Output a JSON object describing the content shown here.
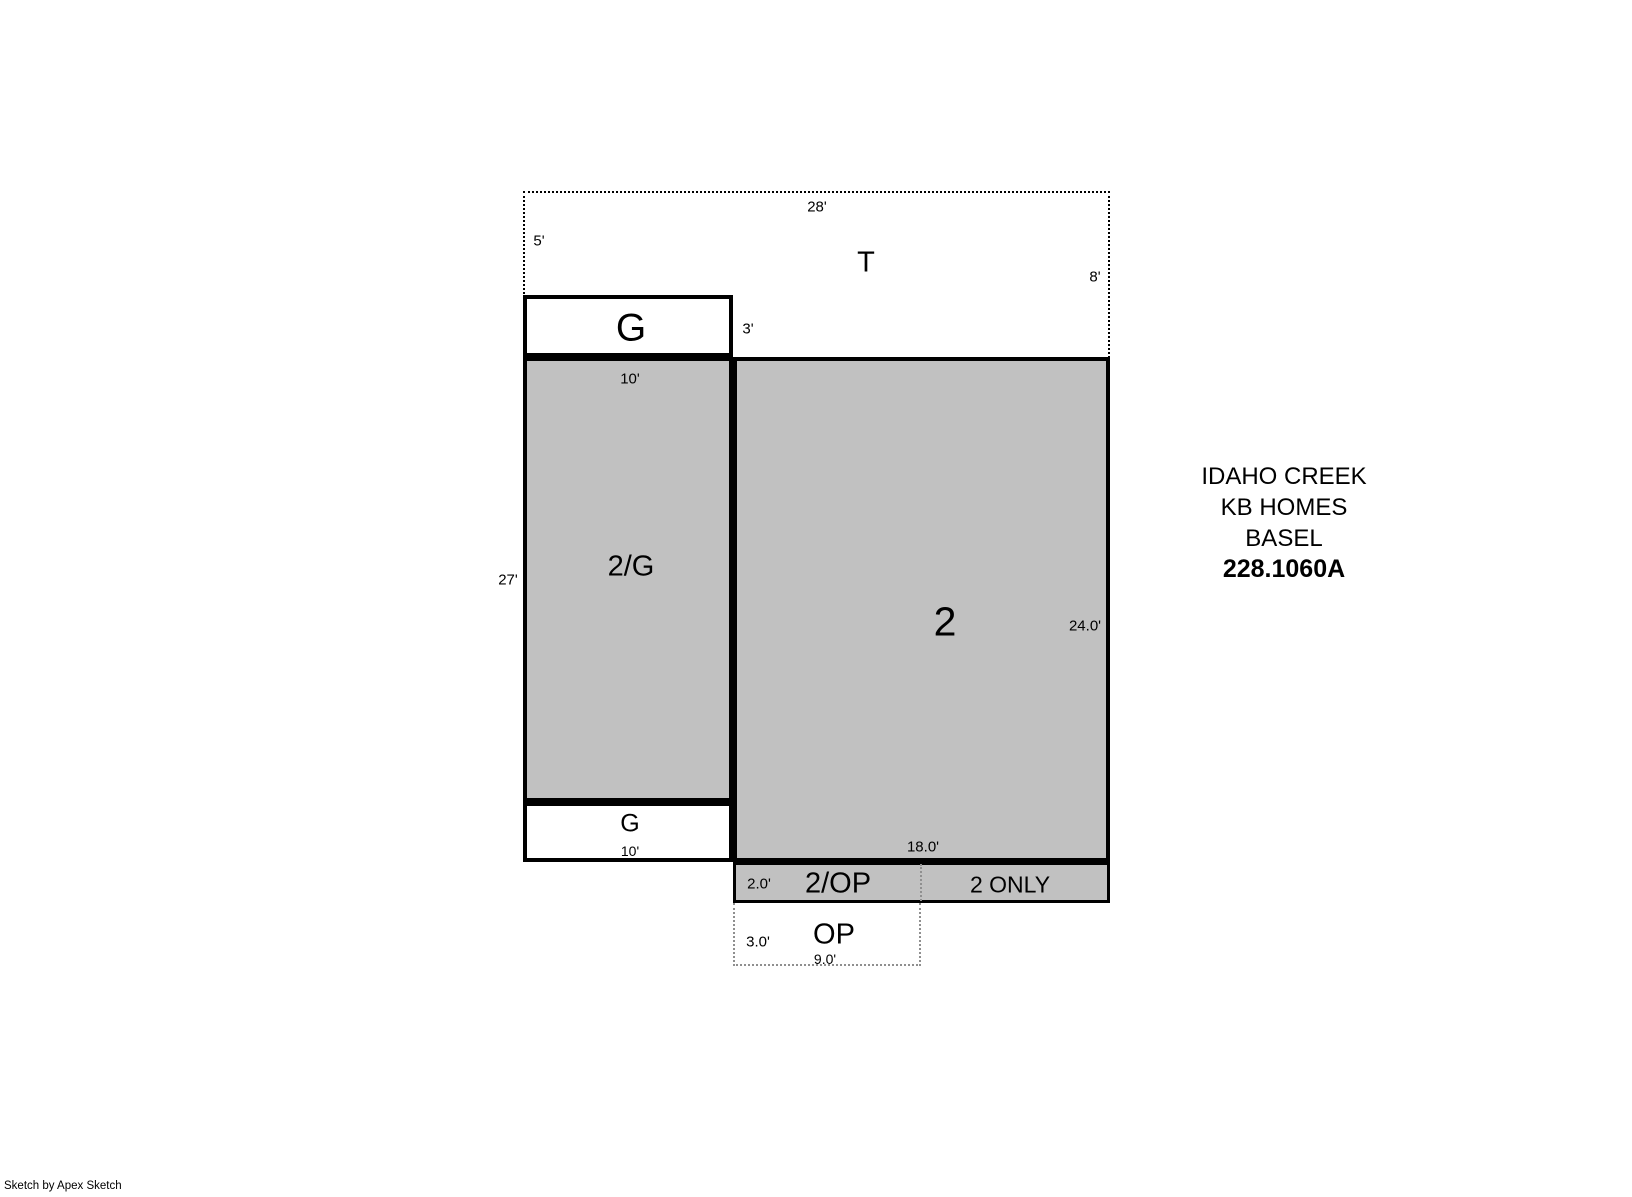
{
  "colors": {
    "area_fill": "#c1c1c1",
    "outline": "#000000",
    "dotted_dark": "#000000",
    "dotted_light": "#8f8f8f",
    "bg": "#ffffff"
  },
  "areas": {
    "t": {
      "label": "T",
      "dim_top": "28'",
      "dim_left": "5'",
      "dim_right": "8'"
    },
    "garage_top": {
      "label": "G",
      "dim_right": "3'"
    },
    "two_g": {
      "label": "2/G",
      "dim_top": "10'",
      "dim_left": "27'"
    },
    "garage_bottom": {
      "label": "G",
      "dim_bottom": "10'"
    },
    "two": {
      "label": "2",
      "dim_right": "24.0'",
      "dim_bottom": "18.0'"
    },
    "two_op": {
      "label": "2/OP",
      "dim_left": "2.0'"
    },
    "two_only": {
      "label": "2 ONLY"
    },
    "op": {
      "label": "OP",
      "dim_left": "3.0'",
      "dim_bottom": "9.0'"
    }
  },
  "title_block": {
    "line1": "IDAHO CREEK",
    "line2": "KB HOMES",
    "line3": "BASEL",
    "line4": "228.1060A"
  },
  "footer": {
    "credit": "Sketch by Apex Sketch"
  }
}
